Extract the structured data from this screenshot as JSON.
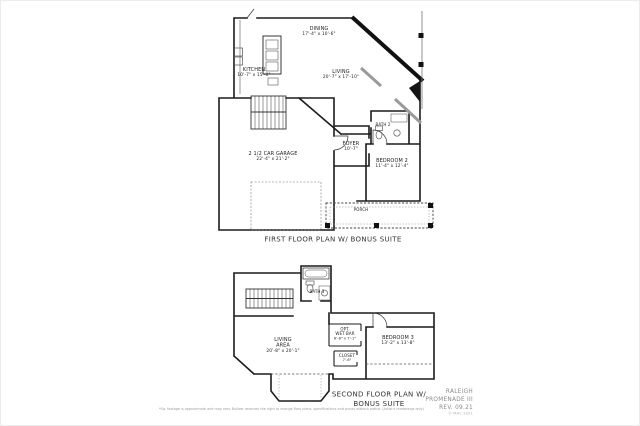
{
  "first_floor": {
    "caption": "FIRST FLOOR PLAN W/ BONUS SUITE",
    "rooms": {
      "dining": {
        "name": "DINING",
        "dims": "17'-4\" x 10'-6\""
      },
      "kitchen": {
        "name": "KITCHEN",
        "dims": "10'-7\" x 15'-0\""
      },
      "living": {
        "name": "LIVING",
        "dims": "20'-7\" x 17'-10\""
      },
      "garage": {
        "name": "2 1/2 CAR GARAGE",
        "dims": "22'-4\" x 21'-2\""
      },
      "foyer": {
        "name": "FOYER",
        "dims": "10'-7\""
      },
      "bath2": {
        "name": "BATH 2"
      },
      "bedroom2": {
        "name": "BEDROOM 2",
        "dims": "11'-4\" x 12'-4\""
      },
      "porch": {
        "name": "PORCH"
      }
    }
  },
  "second_floor": {
    "caption_line1": "SECOND FLOOR PLAN W/",
    "caption_line2": "BONUS SUITE",
    "rooms": {
      "living_area": {
        "name": "LIVING",
        "name2": "AREA",
        "dims": "20'-8\" x 20'-1\""
      },
      "wet_bar": {
        "name": "OPT.",
        "name2": "WET BAR",
        "dims": "6'-8\" x 7'-1\""
      },
      "bedroom3": {
        "name": "BEDROOM 3",
        "dims": "13'-2\" x 13'-8\""
      },
      "closet": {
        "name": "CLOSET",
        "dims": "7'-6\""
      },
      "bath3": {
        "name": "BATH 3"
      }
    }
  },
  "branding": {
    "line1": "RALEIGH",
    "line2": "PROMENADE III",
    "line3": "REV. 09.21",
    "copyright": "© MHC 2021"
  },
  "disclaimer": "*Sq. footage is approximate and may vary. Builder reserves the right to change floor plans, specifications and prices without notice. (Artist's renderings only)",
  "colors": {
    "line_ink": "#1c1c1c",
    "label_text": "#222222",
    "branding_text": "#8a8a8a"
  }
}
